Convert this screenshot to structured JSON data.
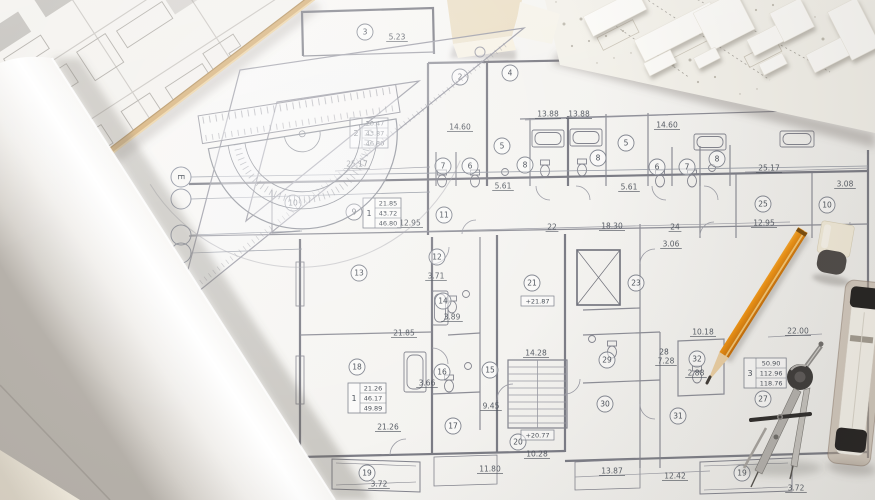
{
  "scene": {
    "setting": "Top-down photo of an architectural floor-plan blueprint on a desk with drafting tools, a paper roll, a site plan sheet and a white scale model",
    "objects": [
      "rolled-paper",
      "site-plan-sheet",
      "floor-plan-blueprint",
      "architectural-scale-model",
      "foam-block",
      "set-square",
      "protractor",
      "ruler",
      "drafting-pencil",
      "compass-divider",
      "eraser",
      "lead-case",
      "wooden-ruler-edge"
    ],
    "colors": {
      "paper": "#f6f5f2",
      "plan_line": "#70707b",
      "ink": "#4b515a",
      "pencil_orange": "#ef9211",
      "wood_tan": "#d5ae74",
      "eraser_cap": "#4c4845",
      "case_cap": "#201e1d",
      "model_base": "#f3f1ea",
      "foam_block": "#ebdfc6"
    }
  },
  "blueprint": {
    "grid_bubbles": [
      {
        "label": "E",
        "x": 181,
        "y": 177,
        "lx": 868,
        "ly": 166
      },
      {
        "label": "",
        "x": 181,
        "y": 199,
        "lx": 430,
        "ly": 192
      },
      {
        "label": "",
        "x": 181,
        "y": 235,
        "lx": 302,
        "ly": 231
      },
      {
        "label": "",
        "x": 181,
        "y": 253,
        "lx": 302,
        "ly": 249
      }
    ],
    "room_numbers": [
      {
        "n": "2",
        "x": 460,
        "y": 77
      },
      {
        "n": "3",
        "x": 365,
        "y": 32
      },
      {
        "n": "4",
        "x": 510,
        "y": 73
      },
      {
        "n": "5",
        "x": 502,
        "y": 146
      },
      {
        "n": "6",
        "x": 470,
        "y": 166
      },
      {
        "n": "7",
        "x": 443,
        "y": 166
      },
      {
        "n": "8",
        "x": 525,
        "y": 165
      },
      {
        "n": "8",
        "x": 598,
        "y": 158
      },
      {
        "n": "5",
        "x": 626,
        "y": 143
      },
      {
        "n": "6",
        "x": 657,
        "y": 167
      },
      {
        "n": "7",
        "x": 687,
        "y": 167
      },
      {
        "n": "8",
        "x": 717,
        "y": 159
      },
      {
        "n": "9",
        "x": 354,
        "y": 212
      },
      {
        "n": "10",
        "x": 293,
        "y": 203
      },
      {
        "n": "11",
        "x": 444,
        "y": 215
      },
      {
        "n": "12",
        "x": 437,
        "y": 257
      },
      {
        "n": "13",
        "x": 359,
        "y": 273
      },
      {
        "n": "14",
        "x": 443,
        "y": 301
      },
      {
        "n": "15",
        "x": 490,
        "y": 370
      },
      {
        "n": "16",
        "x": 442,
        "y": 372
      },
      {
        "n": "17",
        "x": 453,
        "y": 426
      },
      {
        "n": "18",
        "x": 357,
        "y": 367
      },
      {
        "n": "19",
        "x": 367,
        "y": 473
      },
      {
        "n": "19",
        "x": 742,
        "y": 473
      },
      {
        "n": "20",
        "x": 518,
        "y": 442
      },
      {
        "n": "21",
        "x": 532,
        "y": 283
      },
      {
        "n": "23",
        "x": 636,
        "y": 283
      },
      {
        "n": "25",
        "x": 763,
        "y": 204
      },
      {
        "n": "10",
        "x": 827,
        "y": 205
      },
      {
        "n": "27",
        "x": 763,
        "y": 399
      },
      {
        "n": "29",
        "x": 607,
        "y": 360
      },
      {
        "n": "30",
        "x": 605,
        "y": 404
      },
      {
        "n": "31",
        "x": 678,
        "y": 416
      },
      {
        "n": "32",
        "x": 697,
        "y": 359
      }
    ],
    "dimensions": [
      {
        "t": "5.23",
        "x": 397,
        "y": 37
      },
      {
        "t": "14.60",
        "x": 460,
        "y": 127
      },
      {
        "t": "13.88",
        "x": 548,
        "y": 114
      },
      {
        "t": "13.88",
        "x": 579,
        "y": 114
      },
      {
        "t": "14.60",
        "x": 667,
        "y": 125
      },
      {
        "t": "5.61",
        "x": 503,
        "y": 186
      },
      {
        "t": "5.61",
        "x": 629,
        "y": 187
      },
      {
        "t": "25.17",
        "x": 357,
        "y": 164
      },
      {
        "t": "25.17",
        "x": 769,
        "y": 168
      },
      {
        "t": "3.08",
        "x": 845,
        "y": 184
      },
      {
        "t": "12.95",
        "x": 410,
        "y": 223
      },
      {
        "t": "22",
        "x": 552,
        "y": 227
      },
      {
        "t": "18.30",
        "x": 612,
        "y": 226
      },
      {
        "t": "24",
        "x": 675,
        "y": 227
      },
      {
        "t": "3.06",
        "x": 671,
        "y": 244
      },
      {
        "t": "12.95",
        "x": 764,
        "y": 223
      },
      {
        "t": "3.71",
        "x": 436,
        "y": 276
      },
      {
        "t": "3.89",
        "x": 452,
        "y": 317
      },
      {
        "t": "21.85",
        "x": 404,
        "y": 333
      },
      {
        "t": "10.18",
        "x": 703,
        "y": 332
      },
      {
        "t": "7.28",
        "x": 666,
        "y": 361
      },
      {
        "t": "2.88",
        "x": 696,
        "y": 373
      },
      {
        "t": "22.00",
        "x": 798,
        "y": 331
      },
      {
        "t": "3.66",
        "x": 427,
        "y": 383
      },
      {
        "t": "14.28",
        "x": 536,
        "y": 353
      },
      {
        "t": "9.45",
        "x": 491,
        "y": 406
      },
      {
        "t": "21.26",
        "x": 388,
        "y": 427
      },
      {
        "t": "11.80",
        "x": 490,
        "y": 469
      },
      {
        "t": "10.28",
        "x": 537,
        "y": 454
      },
      {
        "t": "13.87",
        "x": 612,
        "y": 471
      },
      {
        "t": "12.42",
        "x": 675,
        "y": 476
      },
      {
        "t": "3.72",
        "x": 379,
        "y": 484
      },
      {
        "t": "3.72",
        "x": 796,
        "y": 488
      }
    ],
    "texts": [
      {
        "t": "28",
        "x": 664,
        "y": 352
      }
    ],
    "area_tables": [
      {
        "unit": "2",
        "rows": [
          "20.47",
          "43.87",
          "46.80"
        ],
        "x": 350,
        "y": 118
      },
      {
        "unit": "1",
        "rows": [
          "21.85",
          "43.72",
          "46.80"
        ],
        "x": 363,
        "y": 198
      },
      {
        "unit": "1",
        "rows": [
          "21.26",
          "46.17",
          "49.89"
        ],
        "x": 348,
        "y": 383
      },
      {
        "unit": "3",
        "rows": [
          "50.90",
          "112.96",
          "118.76"
        ],
        "x": 744,
        "y": 358
      }
    ],
    "elevation_marks": [
      {
        "t": "+21.87",
        "x": 521,
        "y": 296
      },
      {
        "t": "+20.77",
        "x": 521,
        "y": 430
      }
    ]
  }
}
